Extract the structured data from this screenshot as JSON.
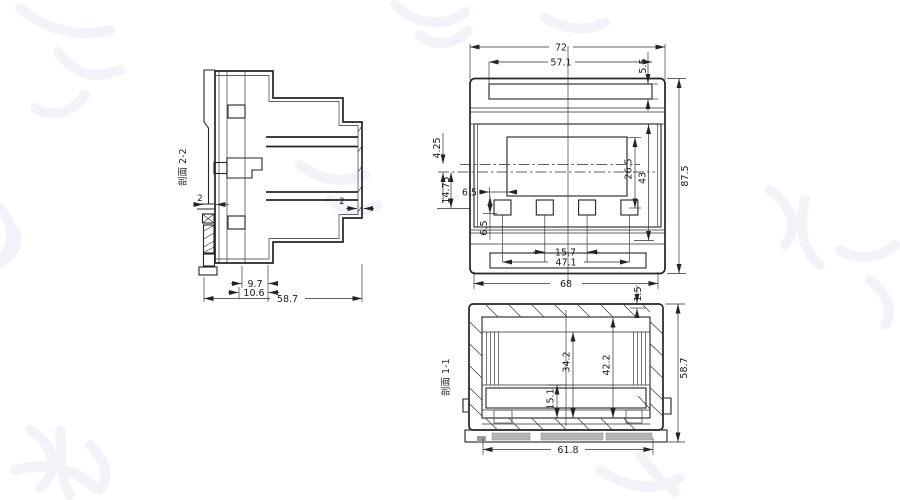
{
  "drawing": {
    "kind": "technical dimensional drawing - DIN-rail enclosure",
    "colors": {
      "line": "#242424",
      "dimension_text": "#1c1c1c",
      "slot_fill": "#b5b5b5",
      "watermark": "#f2f3f8",
      "background": "#ffffff"
    },
    "side_view": {
      "label": "剖面 2-2",
      "dims": {
        "back_wall": "2",
        "front_wall": "2",
        "offset_a": "9.7",
        "offset_b": "10.6",
        "depth": "58.7"
      }
    },
    "front_view": {
      "dims": {
        "overall_width": "72",
        "recess_width": "57.1",
        "recess_height": "5.5",
        "overall_height": "87.5",
        "center_offset": "4.25",
        "button_offset": "14.75",
        "display_margin": "6.5",
        "button_drop": "6.5",
        "window_height": "26.5",
        "face_height": "43",
        "button_pitch": "15.7",
        "button_span": "47.1",
        "base_width": "68",
        "lip": "1.5"
      }
    },
    "bottom_view": {
      "label": "剖面 1-1",
      "dims": {
        "cavity_height": "42.2",
        "inner_height": "34.2",
        "terminal_depth": "15.1",
        "overall_depth": "58.7",
        "inner_width": "61.8"
      }
    }
  }
}
